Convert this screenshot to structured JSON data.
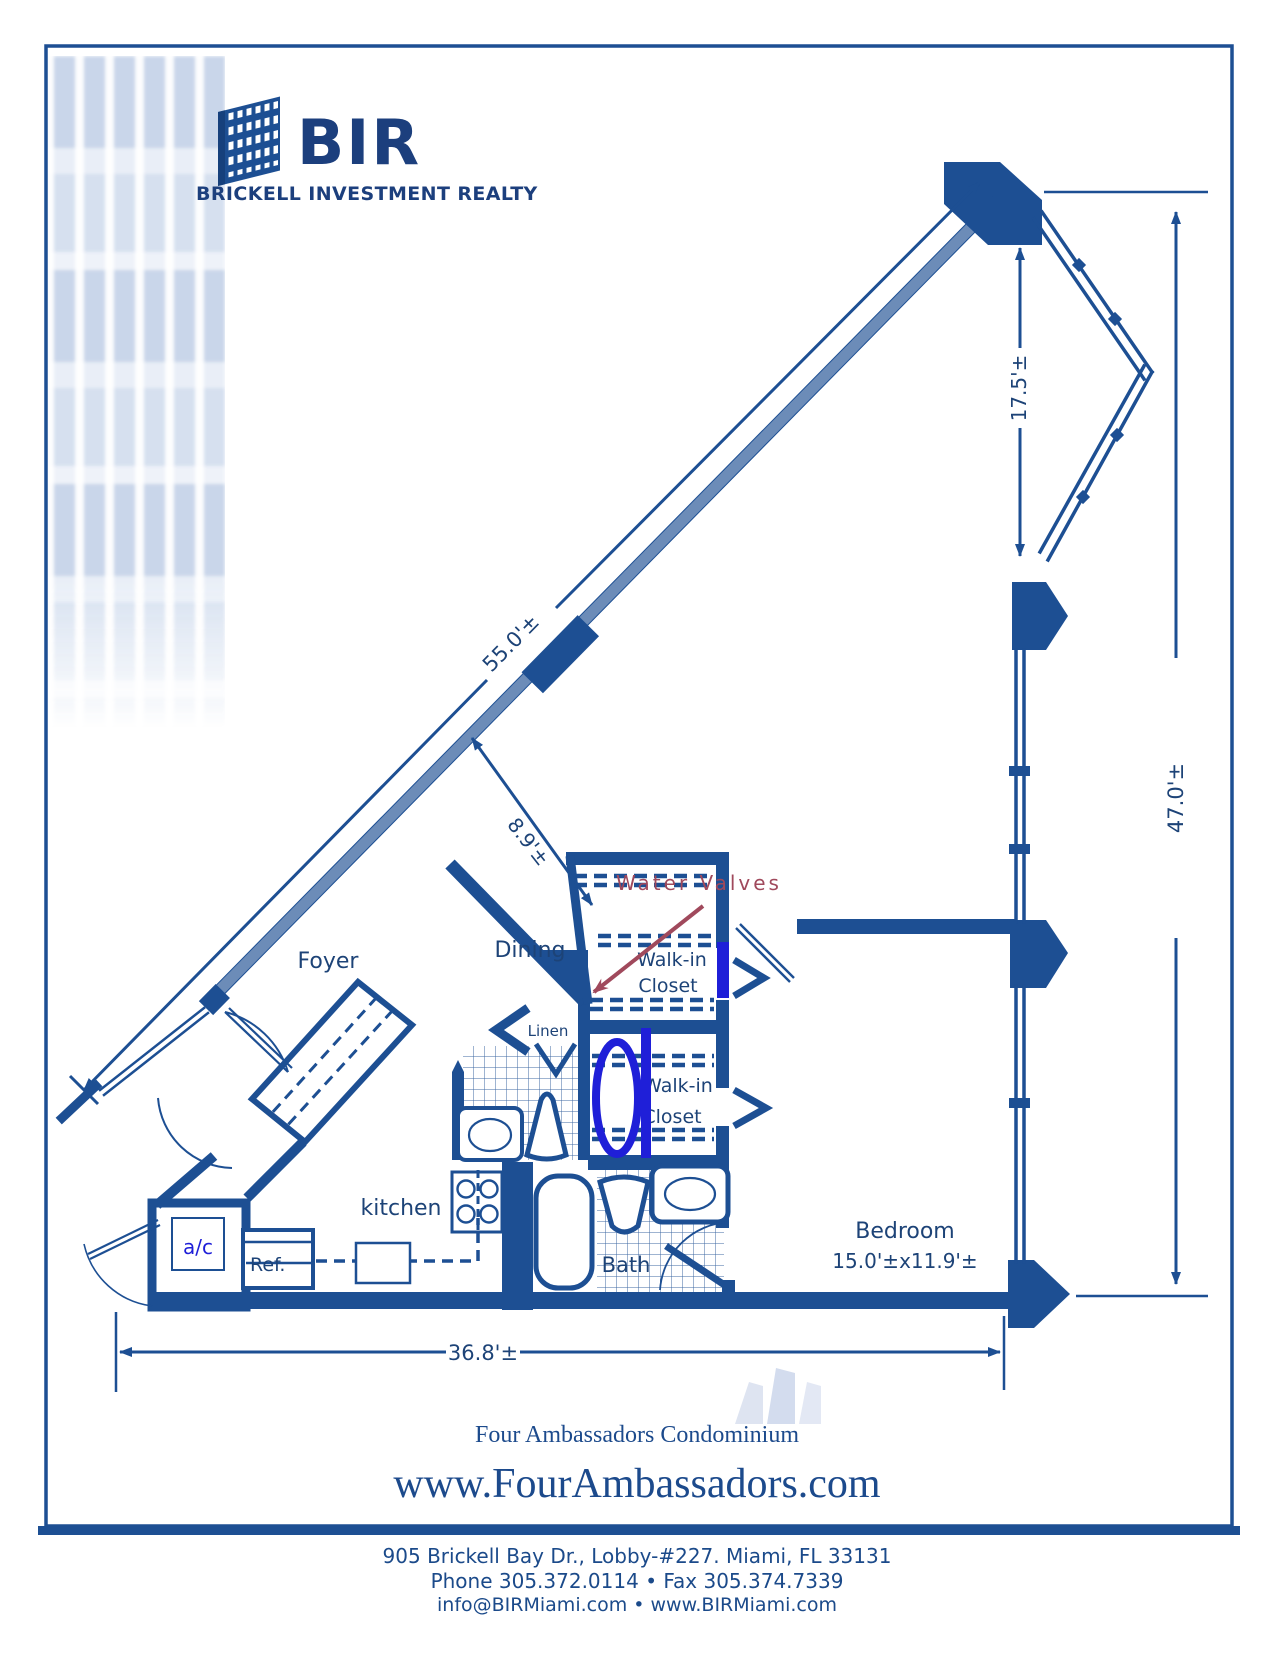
{
  "logo": {
    "abbr": "BIR",
    "tagline": "BRICKELL INVESTMENT REALTY"
  },
  "plan": {
    "labels": {
      "foyer": "Foyer",
      "dining": "Dining",
      "kitchen": "kitchen",
      "bath": "Bath",
      "linen": "Linen",
      "bedroom": "Bedroom",
      "bedroom_size": "15.0'±x11.9'±",
      "walkin_line1": "Walk-in",
      "walkin_line2": "Closet",
      "ref": "Ref.",
      "ac": "a/c"
    },
    "dimensions": {
      "diagonal_wall": "55.0'±",
      "entry_hall": "8.9'±",
      "upper_right": "17.5'±",
      "right_side": "47.0'±",
      "bottom": "36.8'±"
    },
    "annotations": {
      "water_valves": "Water Valves"
    },
    "colors": {
      "wall_navy": "#1d4f93",
      "label_navy": "#1d4377",
      "marker_blue": "#1f1fd8",
      "water_valve_red": "#a0495c"
    }
  },
  "footer": {
    "building_name": "Four Ambassadors Condominium",
    "website": "www.FourAmbassadors.com",
    "address": "905 Brickell Bay Dr., Lobby-#227. Miami, FL 33131",
    "phone_fax": "Phone 305.372.0114  •  Fax 305.374.7339",
    "email_web": "info@BIRMiami.com • www.BIRMiami.com"
  }
}
